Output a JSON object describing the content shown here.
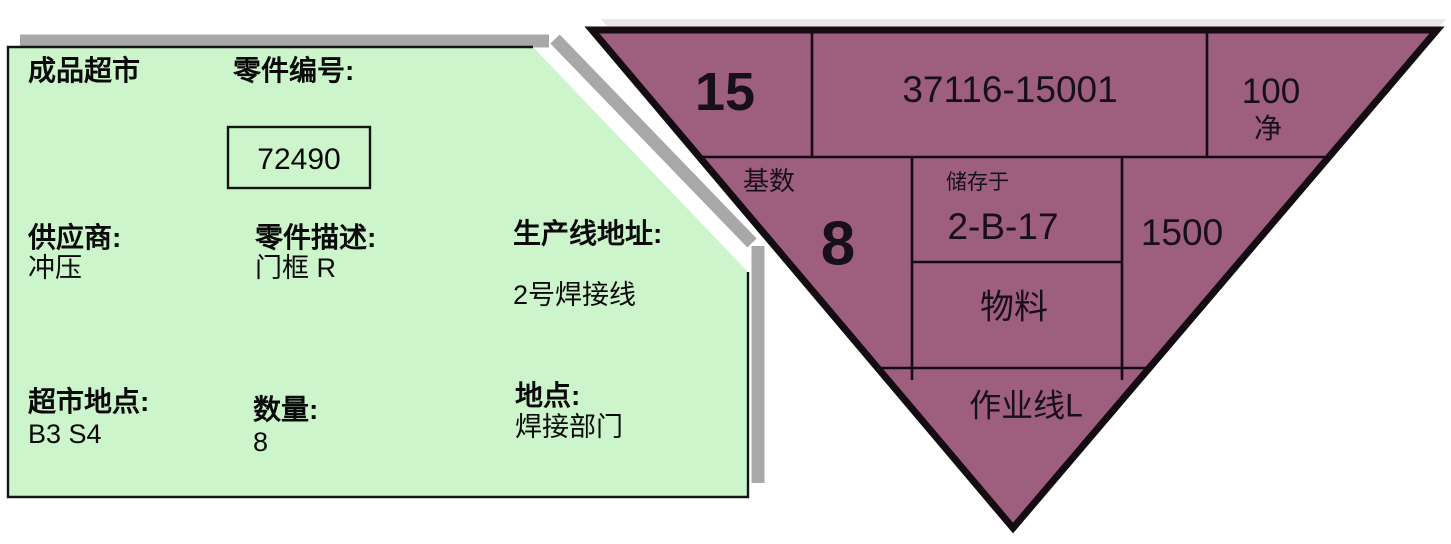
{
  "kanban_card": {
    "title": "成品超市",
    "part_number_label": "零件编号:",
    "part_number": "72490",
    "supplier_label": "供应商:",
    "supplier": "冲压",
    "part_description_label": "零件描述:",
    "part_description": "门框 R",
    "line_address_label": "生产线地址:",
    "line_address": "2号焊接线",
    "market_location_label": "超市地点:",
    "market_location": "B3 S4",
    "quantity_label": "数量:",
    "quantity": "8",
    "location_label": "地点:",
    "location": "焊接部门"
  },
  "kanban_triangle": {
    "trigger_number": "15",
    "part_number": "37116-15001",
    "pack_quantity": "100",
    "net_label": "净",
    "base_label": "基数",
    "base_quantity": "8",
    "store_at_label": "储存于",
    "store_location": "2-B-17",
    "batch_quantity": "1500",
    "material_label": "物料",
    "work_line": "作业线L"
  },
  "colors": {
    "card_fill": "#cdf5cb",
    "card_border": "#141414",
    "card_shadow": "#a8a8a8",
    "triangle_fill": "#9e5e7e",
    "triangle_border": "#140c12",
    "triangle_highlight": "#e9e6e6",
    "background": "#ffffff"
  }
}
